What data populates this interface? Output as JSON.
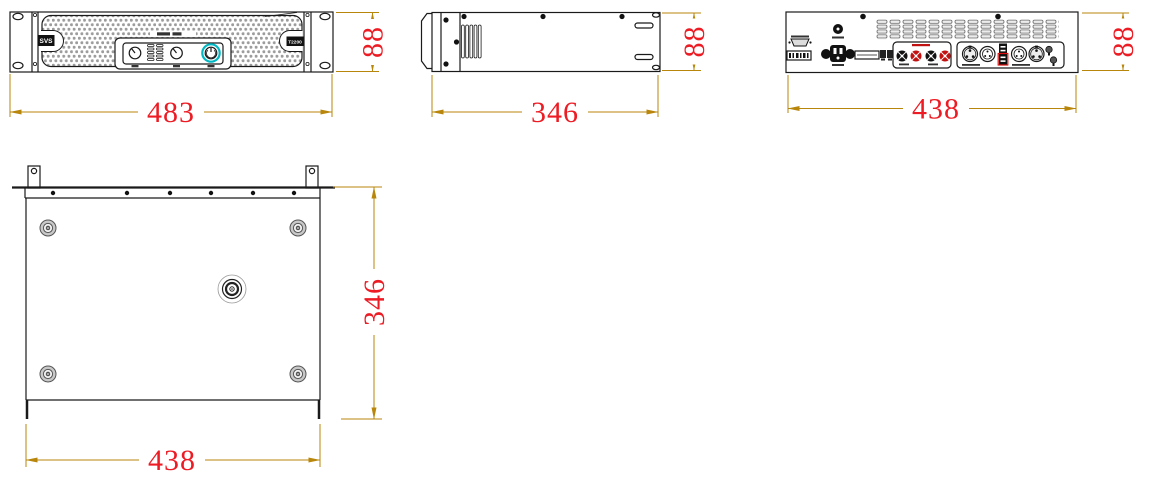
{
  "front_view": {
    "brand_label": "SVS",
    "model_label": "T2200",
    "width_dim": "483",
    "height_dim": "88"
  },
  "side_view": {
    "depth_dim": "346",
    "height_dim": "88"
  },
  "back_view": {
    "width_dim": "438",
    "height_dim": "88"
  },
  "top_view": {
    "width_dim": "438",
    "depth_dim": "346"
  },
  "colors": {
    "dimension_line": "#b8860b",
    "dimension_text": "#ed1c24",
    "outline": "#1a1a1a",
    "power_highlight": "#00b7c3",
    "terminal_red": "#c11111",
    "mesh_dot": "#9c9c9c"
  }
}
